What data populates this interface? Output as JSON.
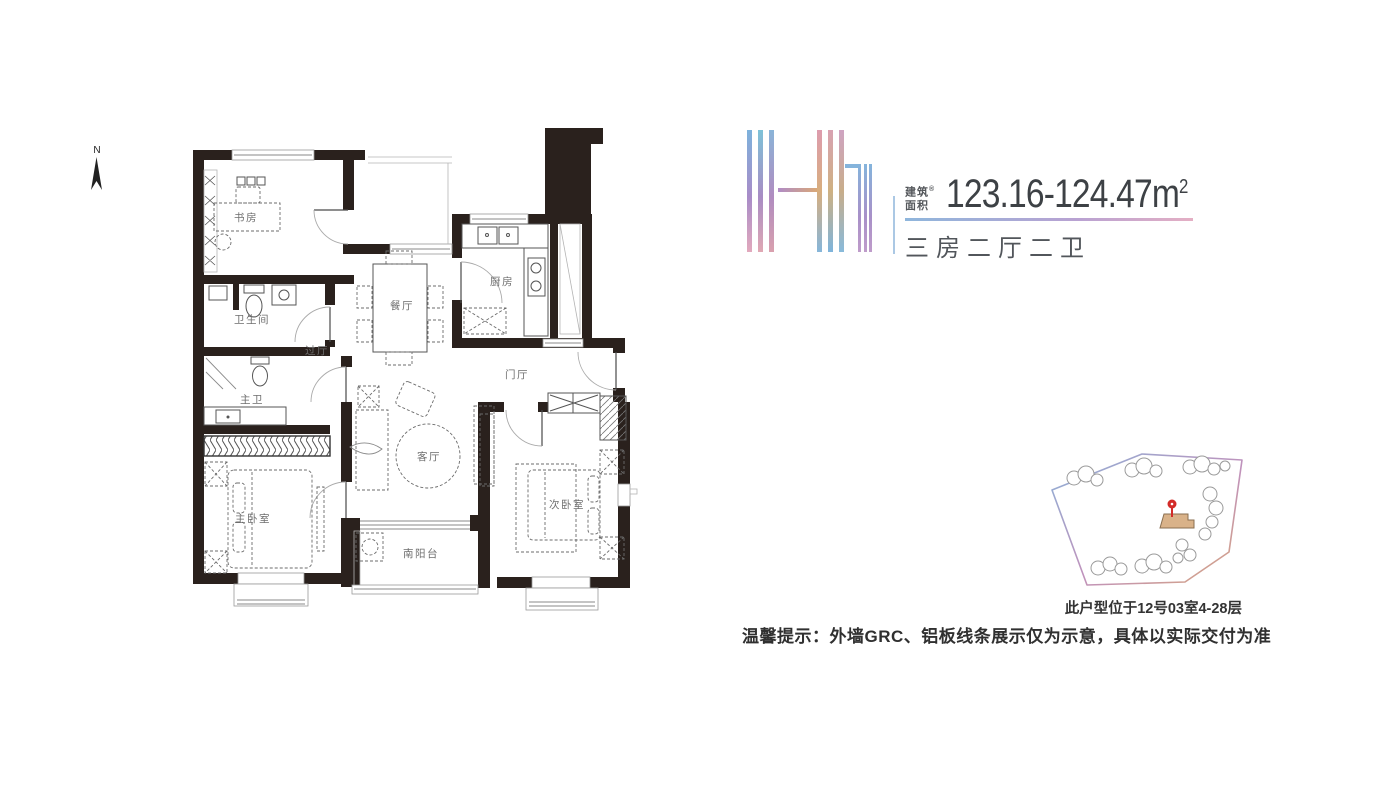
{
  "header": {
    "unit_name": "H1",
    "area_prefix_line1": "建筑",
    "area_prefix_line2": "面积",
    "area_prefix_mark": "®",
    "area_value": "123.16-124.47",
    "area_unit_base": "m",
    "area_unit_sup": "2",
    "layout_summary": "三房二厅二卫"
  },
  "floorplan": {
    "compass_label": "N",
    "rooms": {
      "study": "书房",
      "bath": "卫生间",
      "hallway": "过厅",
      "dining": "餐厅",
      "kitchen": "厨房",
      "foyer": "门厅",
      "master_bath": "主卫",
      "master_bedroom": "主卧室",
      "living": "客厅",
      "second_bedroom": "次卧室",
      "south_balcony": "南阳台"
    }
  },
  "siteplan": {
    "location_note": "此户型位于12号03室4-28层"
  },
  "footer": {
    "disclaimer": "温馨提示：外墙GRC、铝板线条展示仅为示意，具体以实际交付为准"
  },
  "colors": {
    "wall": "#2a211d",
    "logo_palette": [
      "#7db2dc",
      "#a88cc8",
      "#e2a9bd",
      "#d8ae7e",
      "#86b6da"
    ],
    "underline_gradient": [
      "#8fb6dc",
      "#b9a2d2",
      "#e4afc4"
    ],
    "site_border_gradient": [
      "#8cb2d8",
      "#c092bc",
      "#d8a67c"
    ],
    "highlight_building": "#d9b289",
    "pin": "#d32b28"
  }
}
